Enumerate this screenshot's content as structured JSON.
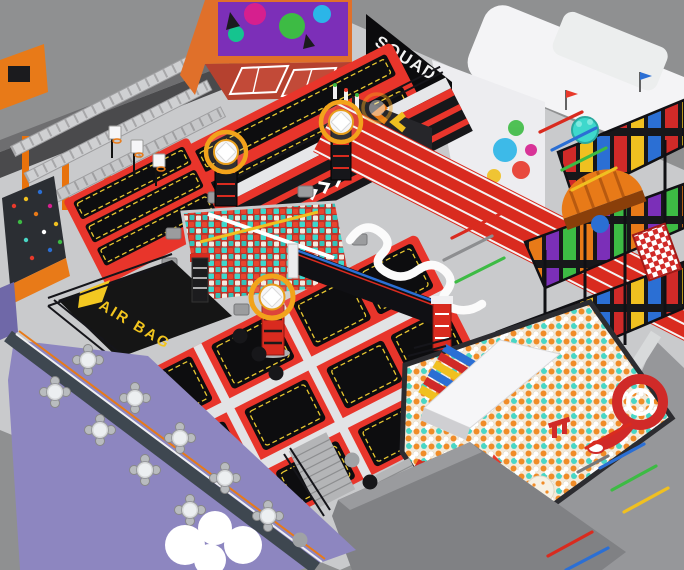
{
  "scene": {
    "subject": "isometric 3d render of an indoor trampoline park interior",
    "banner": {
      "line1": "SQUAD",
      "line2": "UP"
    },
    "airbag": {
      "label": "AIR BAG"
    },
    "palette": {
      "outer_floor": "#8f9091",
      "interior_floor": "#c9cacc",
      "wall_dark": "#4a4a4c",
      "accent_red": "#e8352b",
      "track_red": "#d92b1f",
      "mat_black": "#0d0d0f",
      "stitch_yellow": "#e9c832",
      "structure_orange": "#e87a18",
      "foam_teal": "#3ed8cc",
      "cafe_purple": "#8d86c0",
      "ball_orange": "#f08c28",
      "panel_blue": "#2b6fd4",
      "panel_green": "#3dbb44",
      "white": "#f6f6f8"
    },
    "zones": [
      "ninja-truss-course",
      "climbing-wall",
      "basketball-dunk-lanes",
      "trampoline-lanes",
      "dodgeball-room",
      "squad-up-banner",
      "elevated-platform",
      "foam-cube-pit",
      "air-bag-pit",
      "main-trampoline-court",
      "running-track",
      "balance-squiggle",
      "graffiti-building",
      "soft-play-structure",
      "ball-pit",
      "drop-slide",
      "spiral-slide",
      "rainbow-steps",
      "cafe-seating",
      "target-rings",
      "floor-darts",
      "stairs",
      "cloud-seat"
    ],
    "floor_dart_colors": [
      "#d92b1f",
      "#2b6fd4",
      "#3dbb44",
      "#f0c020",
      "#8d8e90"
    ]
  }
}
